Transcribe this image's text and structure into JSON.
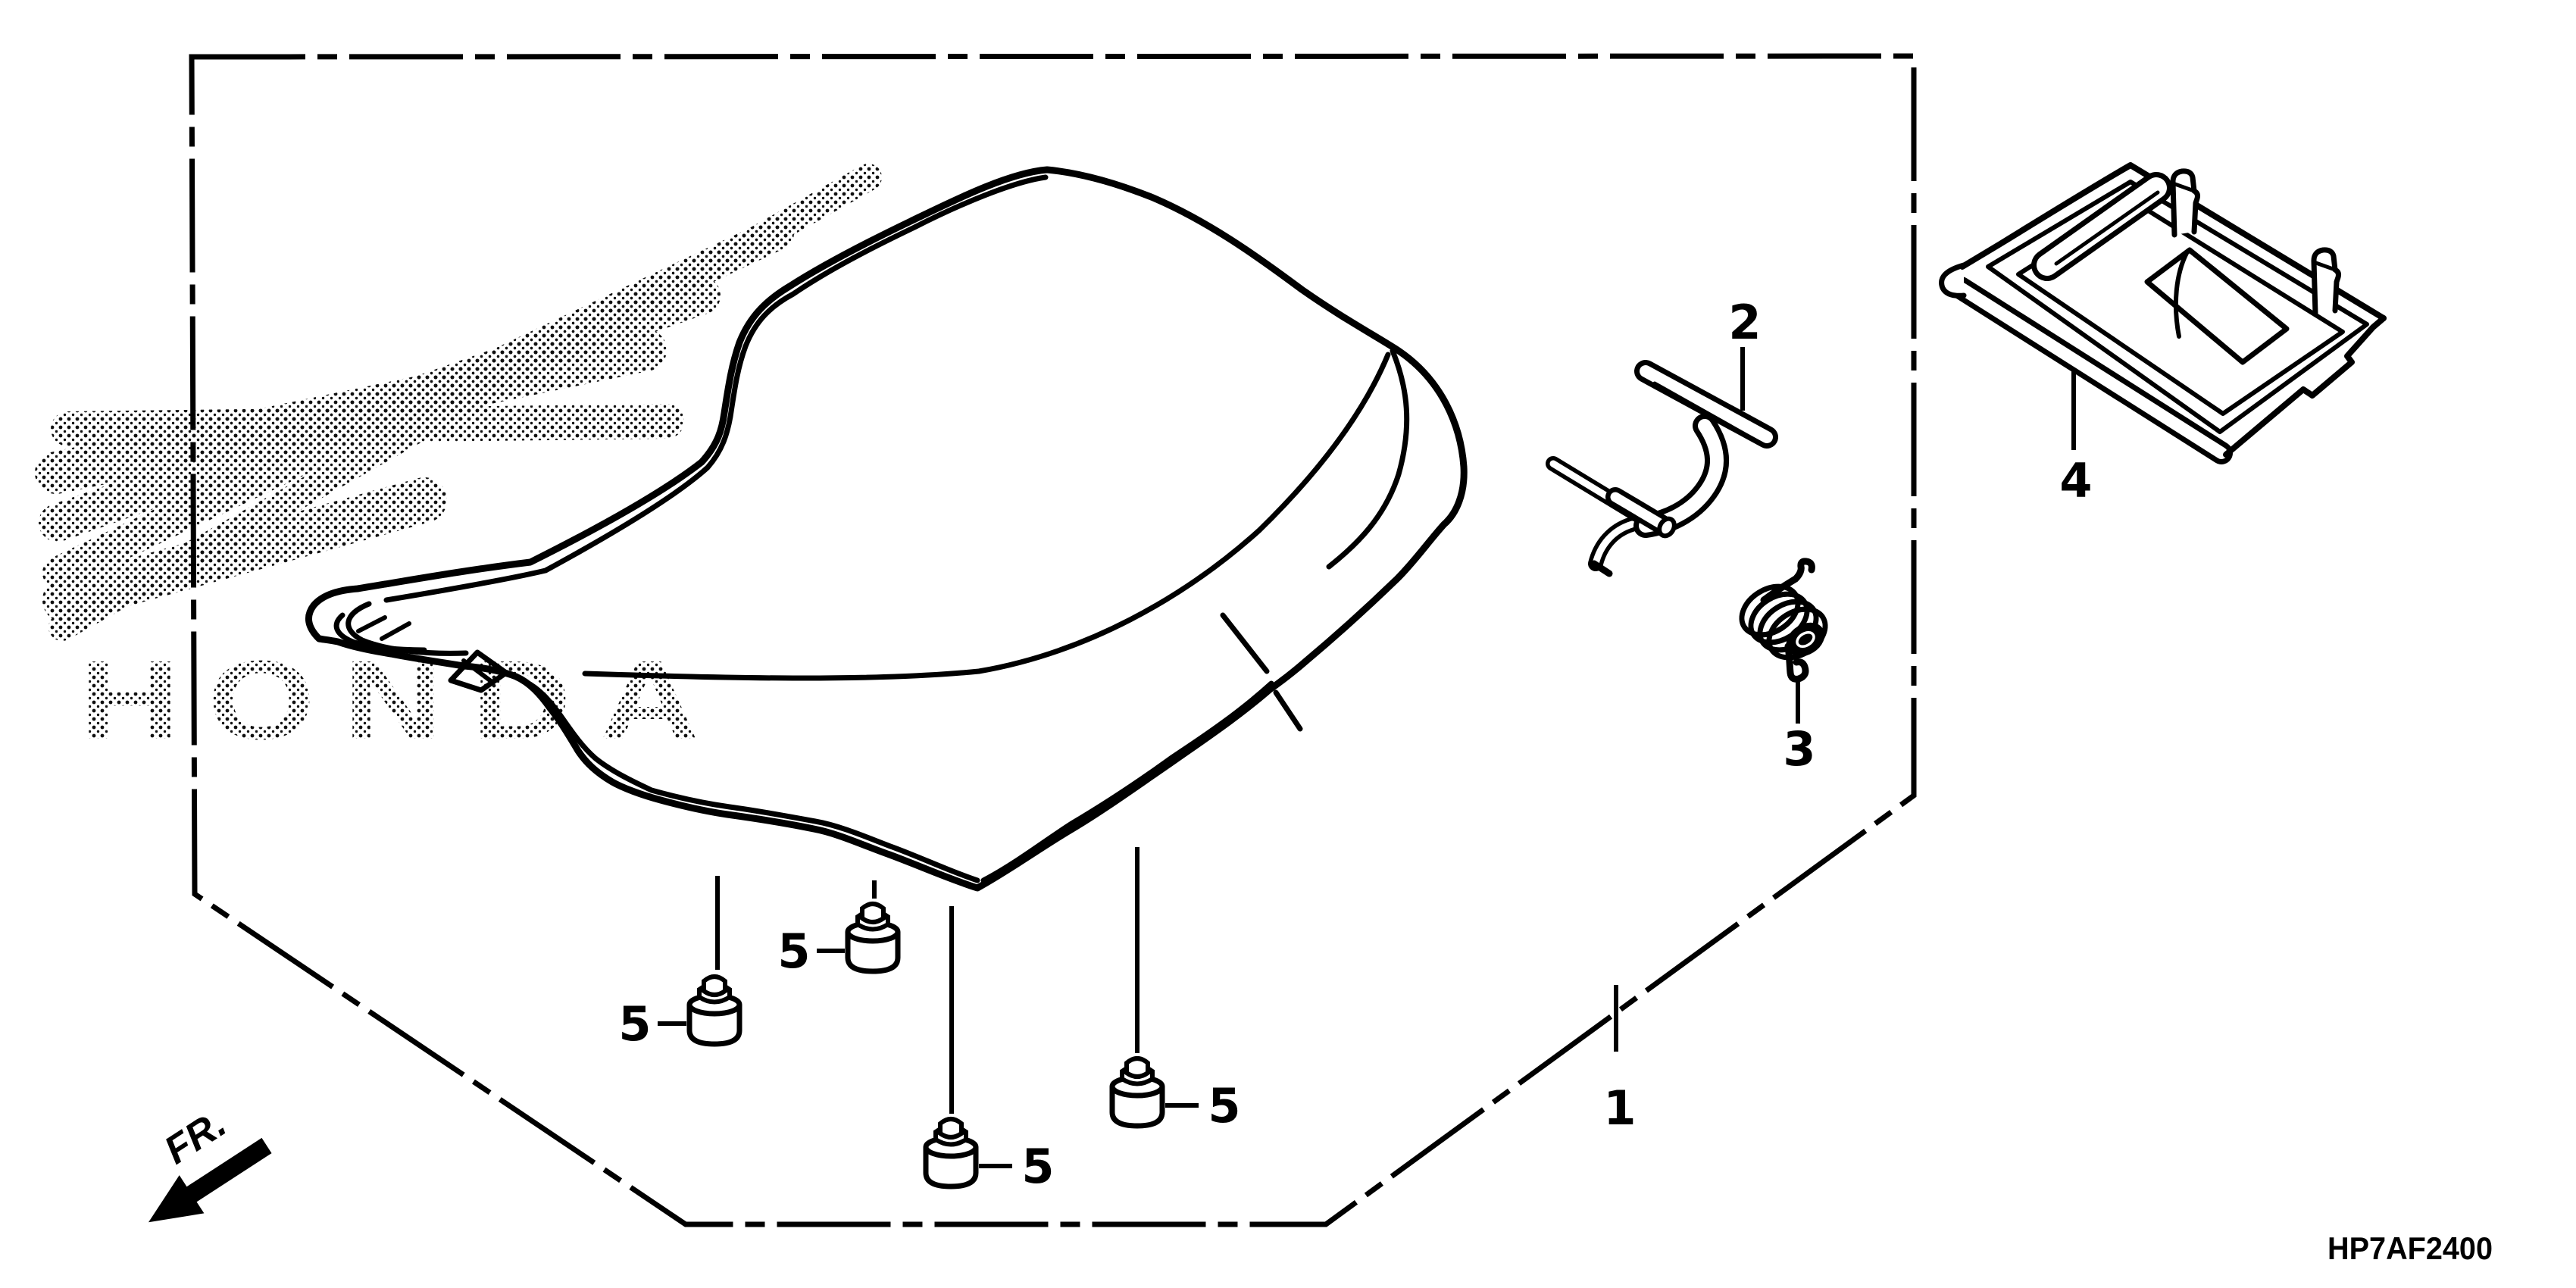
{
  "page": {
    "background_color": "#ffffff",
    "ink_color": "#000000",
    "type": "parts-diagram"
  },
  "diagram": {
    "code": "HP7AF2400",
    "front_direction_label": "FR.",
    "watermark_text": "HONDA",
    "watermark_style": "halftone-dots",
    "labels": {
      "p1": "1",
      "p2": "2",
      "p3": "3",
      "p4": "4",
      "p5": "5"
    },
    "parts": [
      {
        "ref": "1",
        "depicts": "seat assembly (whole drawing in dashed boundary)"
      },
      {
        "ref": "2",
        "depicts": "seat lock bracket"
      },
      {
        "ref": "3",
        "depicts": "seat lock spring"
      },
      {
        "ref": "4",
        "depicts": "seat bottom plate"
      },
      {
        "ref": "5",
        "depicts": "seat rubber cushion (x4)"
      }
    ]
  }
}
